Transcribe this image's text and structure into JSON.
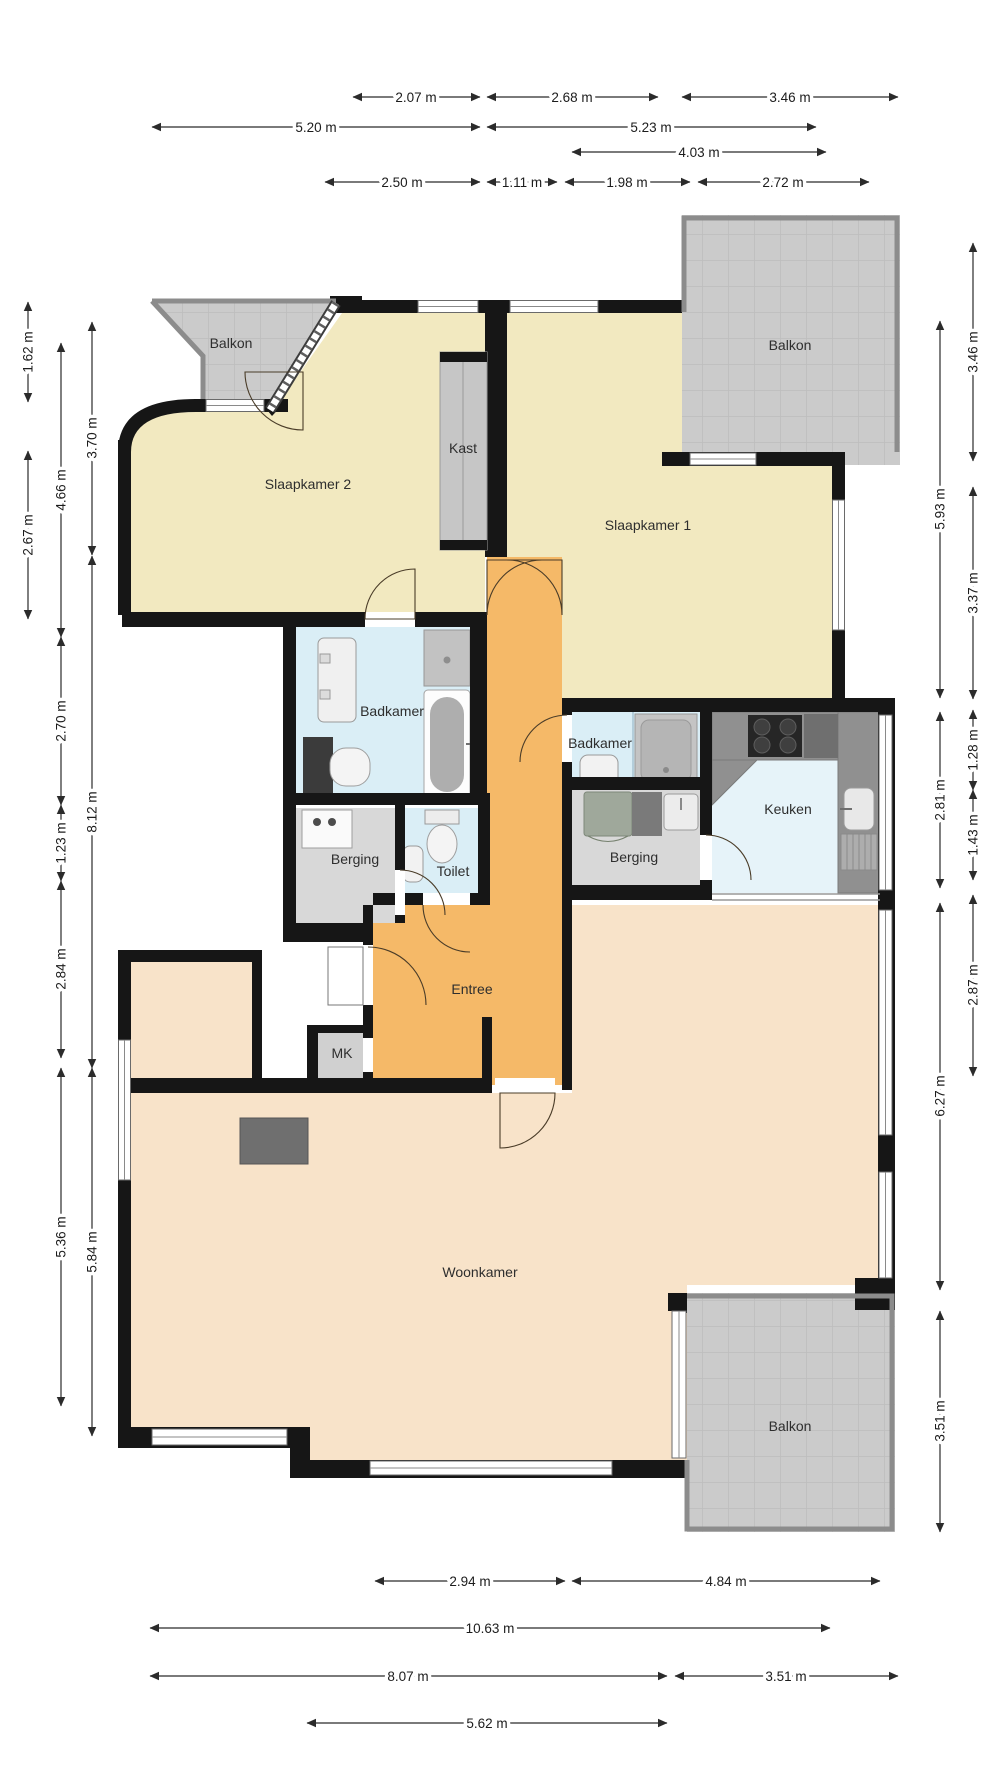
{
  "rooms": {
    "balkon_tl": "Balkon",
    "slaapkamer2": "Slaapkamer 2",
    "kast": "Kast",
    "slaapkamer1": "Slaapkamer 1",
    "balkon_tr": "Balkon",
    "badkamer_l": "Badkamer",
    "badkamer_r": "Badkamer",
    "keuken": "Keuken",
    "berging_l": "Berging",
    "toilet": "Toilet",
    "berging_r": "Berging",
    "entree": "Entree",
    "mk": "MK",
    "woonkamer": "Woonkamer",
    "balkon_br": "Balkon"
  },
  "dims": {
    "top": [
      "2.07 m",
      "2.68 m",
      "3.46 m",
      "5.20 m",
      "5.23 m",
      "4.03 m",
      "2.50 m",
      "1.11 m",
      "1.98 m",
      "2.72 m"
    ],
    "left": [
      "1.62 m",
      "2.67 m",
      "4.66 m",
      "2.70 m",
      "1.23 m",
      "2.84 m",
      "5.36 m",
      "3.70 m",
      "8.12 m",
      "5.84 m"
    ],
    "right": [
      "3.46 m",
      "3.37 m",
      "1.28 m",
      "1.43 m",
      "2.87 m",
      "5.93 m",
      "2.81 m",
      "6.27 m",
      "3.51 m"
    ],
    "bottom": [
      "2.94 m",
      "4.84 m",
      "10.63 m",
      "8.07 m",
      "3.51 m",
      "5.62 m"
    ]
  },
  "colors": {
    "wall": "#161616",
    "bedroom_floor": "#f2e9c0",
    "hall_floor": "#f5b968",
    "living_floor": "#f8e3c9",
    "bath_floor": "#daeef6",
    "kitchen_floor": "#e6f3f9",
    "balcony_floor": "#cccccc",
    "storage_floor": "#d8d8d8"
  }
}
